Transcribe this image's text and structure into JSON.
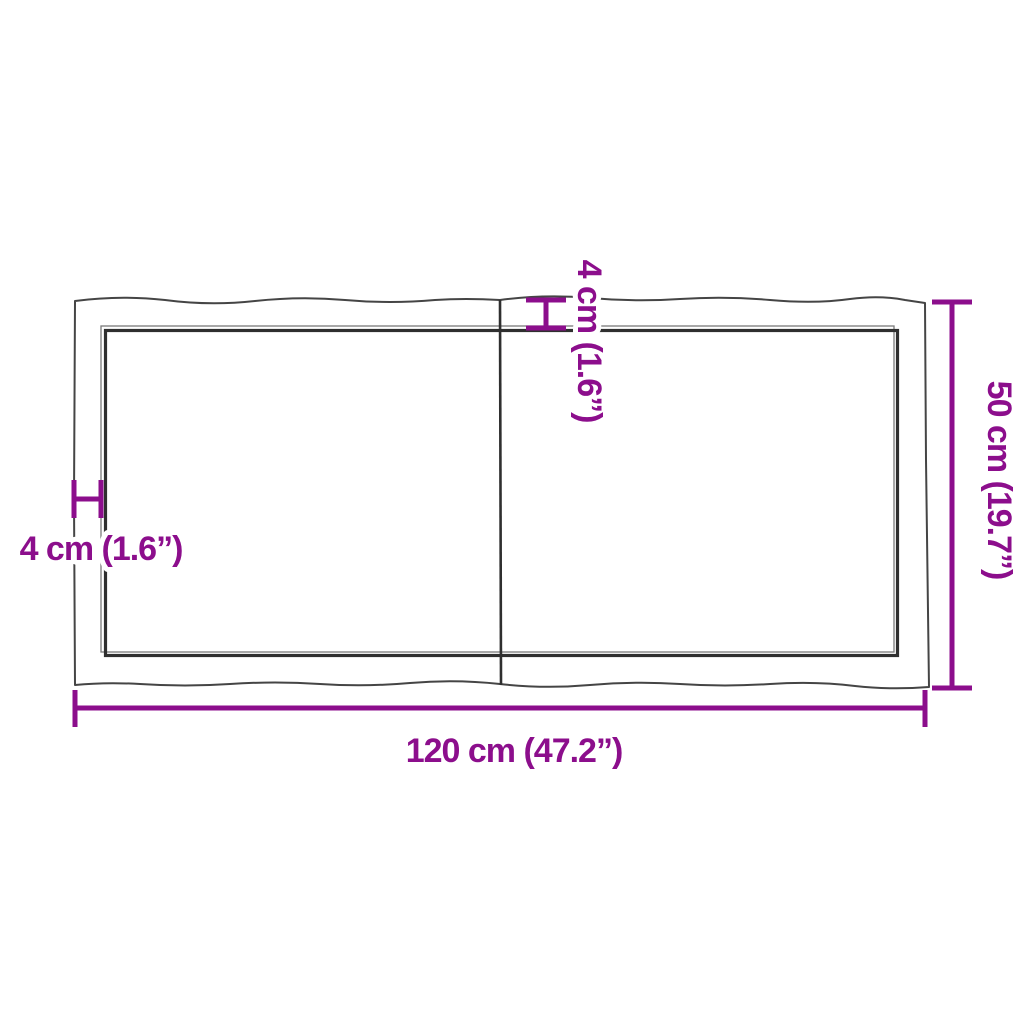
{
  "diagram": {
    "title": "table-top-dimension-diagram",
    "colors": {
      "accent_magenta": "#8c0e8c",
      "board_outline": "#454545",
      "board_edge_dark": "#2f2f2f",
      "board_edge_light": "#7a7a7a",
      "background": "#ffffff"
    },
    "dimensions": {
      "width": {
        "value_cm": 120,
        "value_in": 47.2,
        "label": "120 cm (47.2”)"
      },
      "height": {
        "value_cm": 50,
        "value_in": 19.7,
        "label": "50 cm (19.7”)"
      },
      "thickness_left": {
        "value_cm": 4,
        "value_in": 1.6,
        "label": "4 cm (1.6”)"
      },
      "thickness_top": {
        "value_cm": 4,
        "value_in": 1.6,
        "label": "4 cm (1.6”)"
      }
    }
  }
}
